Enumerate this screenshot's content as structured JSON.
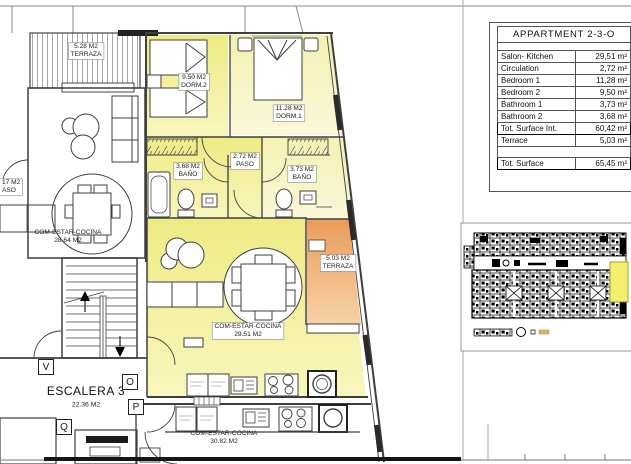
{
  "title_block": {
    "title": "APPARTMENT 2-3-O",
    "rows": [
      {
        "label": "Salon- Kitchen",
        "value": "29,51 m²"
      },
      {
        "label": "Circulation",
        "value": "2,72 m²"
      },
      {
        "label": "Bedroom 1",
        "value": "11,28 m²"
      },
      {
        "label": "Bedroom 2",
        "value": "9,50 m²"
      },
      {
        "label": "Bathroom 1",
        "value": "3,73 m²"
      },
      {
        "label": "Bathroom 2",
        "value": "3,68 m²"
      },
      {
        "label": "Tot. Surface Int.",
        "value": "60,42 m²"
      },
      {
        "label": "Terrace",
        "value": "5,03 m²"
      },
      {
        "label": "Tot. Surface",
        "value": "65,45 m²"
      }
    ]
  },
  "plan": {
    "labels": {
      "terrace_nw_area": "5.28 M2",
      "terrace_nw_name": "TERRAZA",
      "neighbor_nw_name": "COM-ESTAR-COCINA",
      "neighbor_nw_area": "28.64 M2",
      "paso_w_area": "17 M2",
      "paso_w_name": "ASO",
      "dorm2_area": "9.50 M2",
      "dorm2_name": "DORM.2",
      "dorm1_area": "11.28 M2",
      "dorm1_name": "DORM.1",
      "paso_area": "2.72 M2",
      "paso_name": "PASO",
      "bano2_area": "3.68 M2",
      "bano2_name": "BAÑO",
      "bano1_area": "3.73 M2",
      "bano1_name": "BAÑO",
      "salon_name": "COM-ESTAR-COCINA",
      "salon_area": "29.51 M2",
      "terrace_e_area": "5.03 M2",
      "terrace_e_name": "TERRAZA",
      "escalera_name": "ESCALERA 3",
      "escalera_area": "22.36 M2",
      "neighbor_s_name": "COM-ESTAR-COCINA",
      "neighbor_s_area": "30.82 M2",
      "marker_v": "V",
      "marker_o": "O",
      "marker_p": "P",
      "marker_q": "Q"
    }
  },
  "colors": {
    "apartment_fill": "#efec88",
    "apartment_fill_light": "#f4f2b8",
    "terrace_fill": "#eb9d5c",
    "keyplan_highlight": "#f2ee70",
    "wall": "#3f3f3f"
  }
}
